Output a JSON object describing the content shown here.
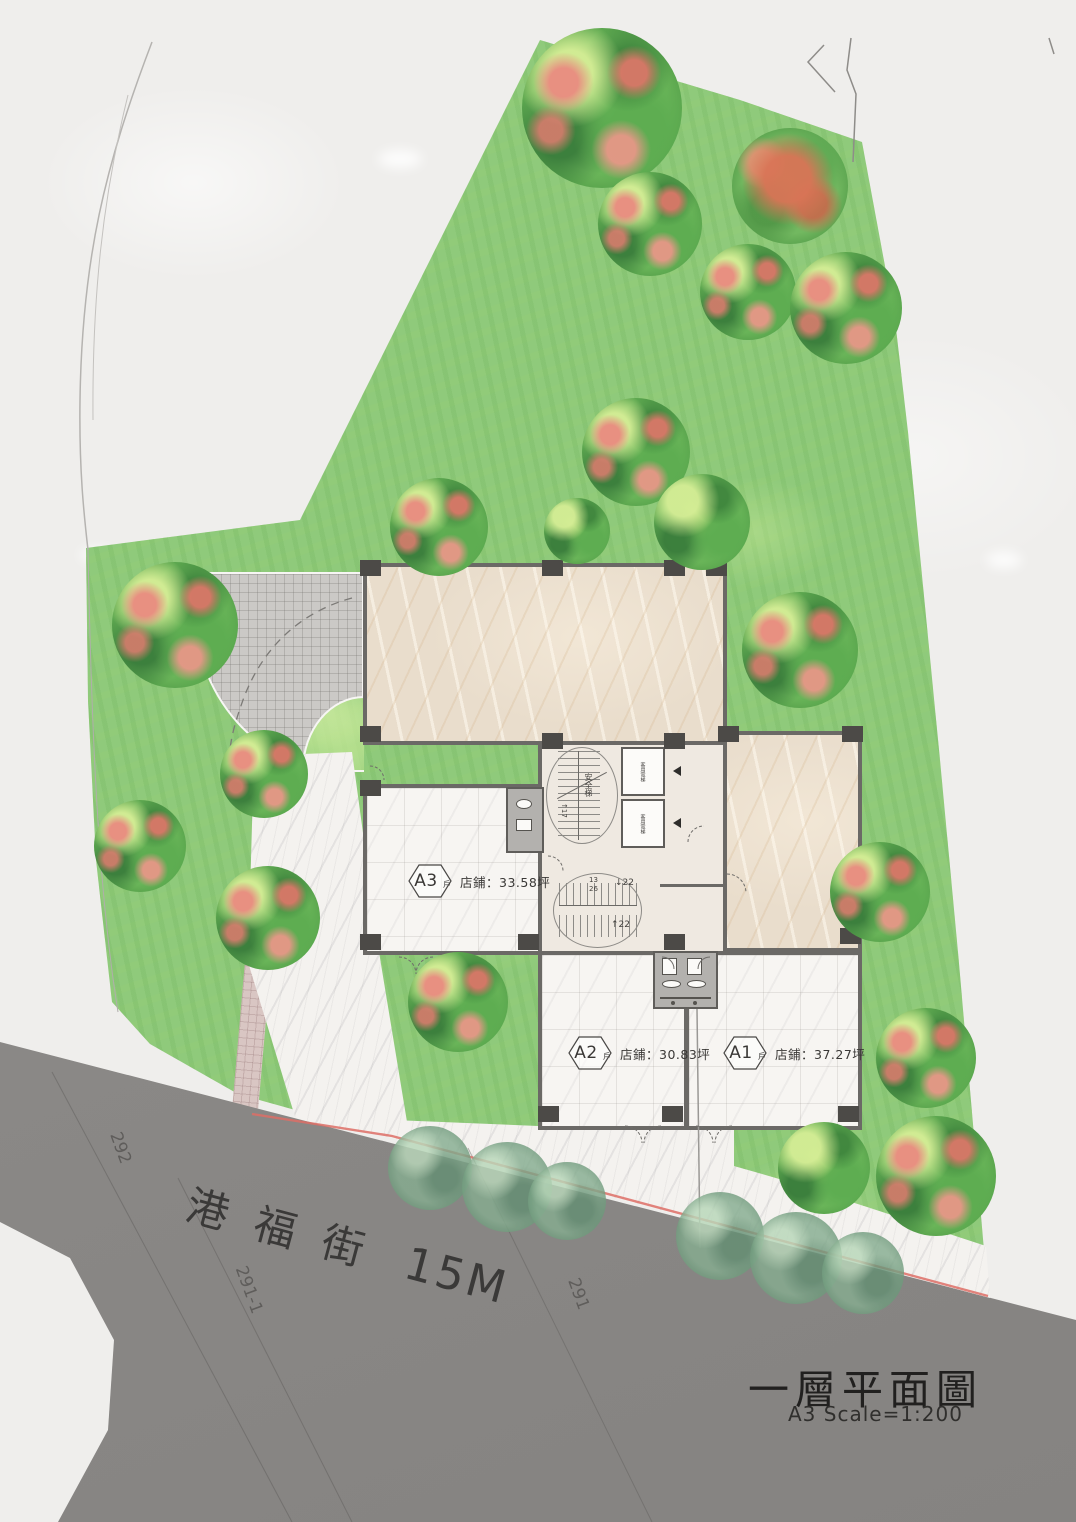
{
  "plan": {
    "title": "一層平面圖",
    "scale": "A3 Scale=1:200",
    "road_name": "港福街",
    "road_width": "15M",
    "parcels": [
      {
        "label": "292"
      },
      {
        "label": "291-1"
      },
      {
        "label": "291"
      }
    ],
    "units": [
      {
        "code": "A3",
        "suffix": "戶",
        "area": "店鋪：33.58坪"
      },
      {
        "code": "A2",
        "suffix": "戶",
        "area": "店鋪：30.83坪"
      },
      {
        "code": "A1",
        "suffix": "戶",
        "area": "店鋪：37.27坪"
      }
    ],
    "core": {
      "stair_upper_label": "安全梯",
      "stair_upper_flight": "↑17",
      "stair_lower_up": "↑22",
      "stair_lower_down": "↓22",
      "stair_lower_riser_top": "13",
      "stair_lower_riser_bottom": "26",
      "elevator_1": "客用電梯",
      "elevator_2": "客用電梯"
    },
    "colors": {
      "lawn": "#8fca7b",
      "road": "#8b8987",
      "marble_tan": "#e9ddcc",
      "marble_white": "#f6f4f1",
      "boundary_pink": "#dd6f66",
      "paper": "#efeeec"
    }
  }
}
